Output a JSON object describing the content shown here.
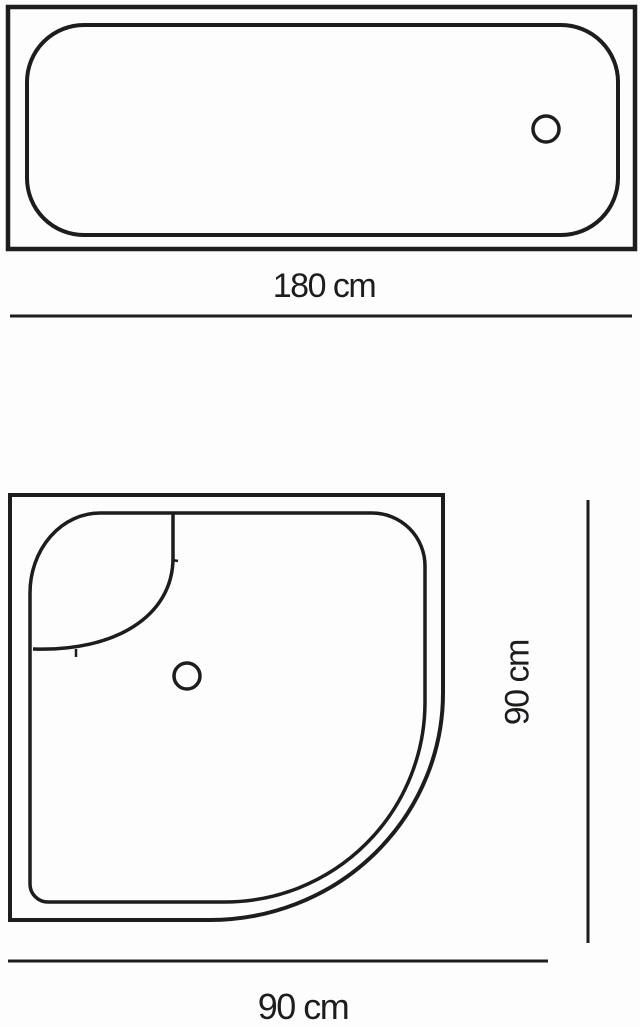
{
  "diagram": {
    "kind": "technical dimension drawing",
    "subject": "bathtub and quadrant shower tray, top views",
    "bathtub": {
      "width_label": "180 cm",
      "width_cm": 180
    },
    "shower_tray": {
      "height_label": "90 cm",
      "width_label": "90 cm",
      "width_cm": 90,
      "depth_cm": 90
    },
    "colors": {
      "line": "#1d1d1b",
      "background": "#fdfdfd"
    }
  }
}
